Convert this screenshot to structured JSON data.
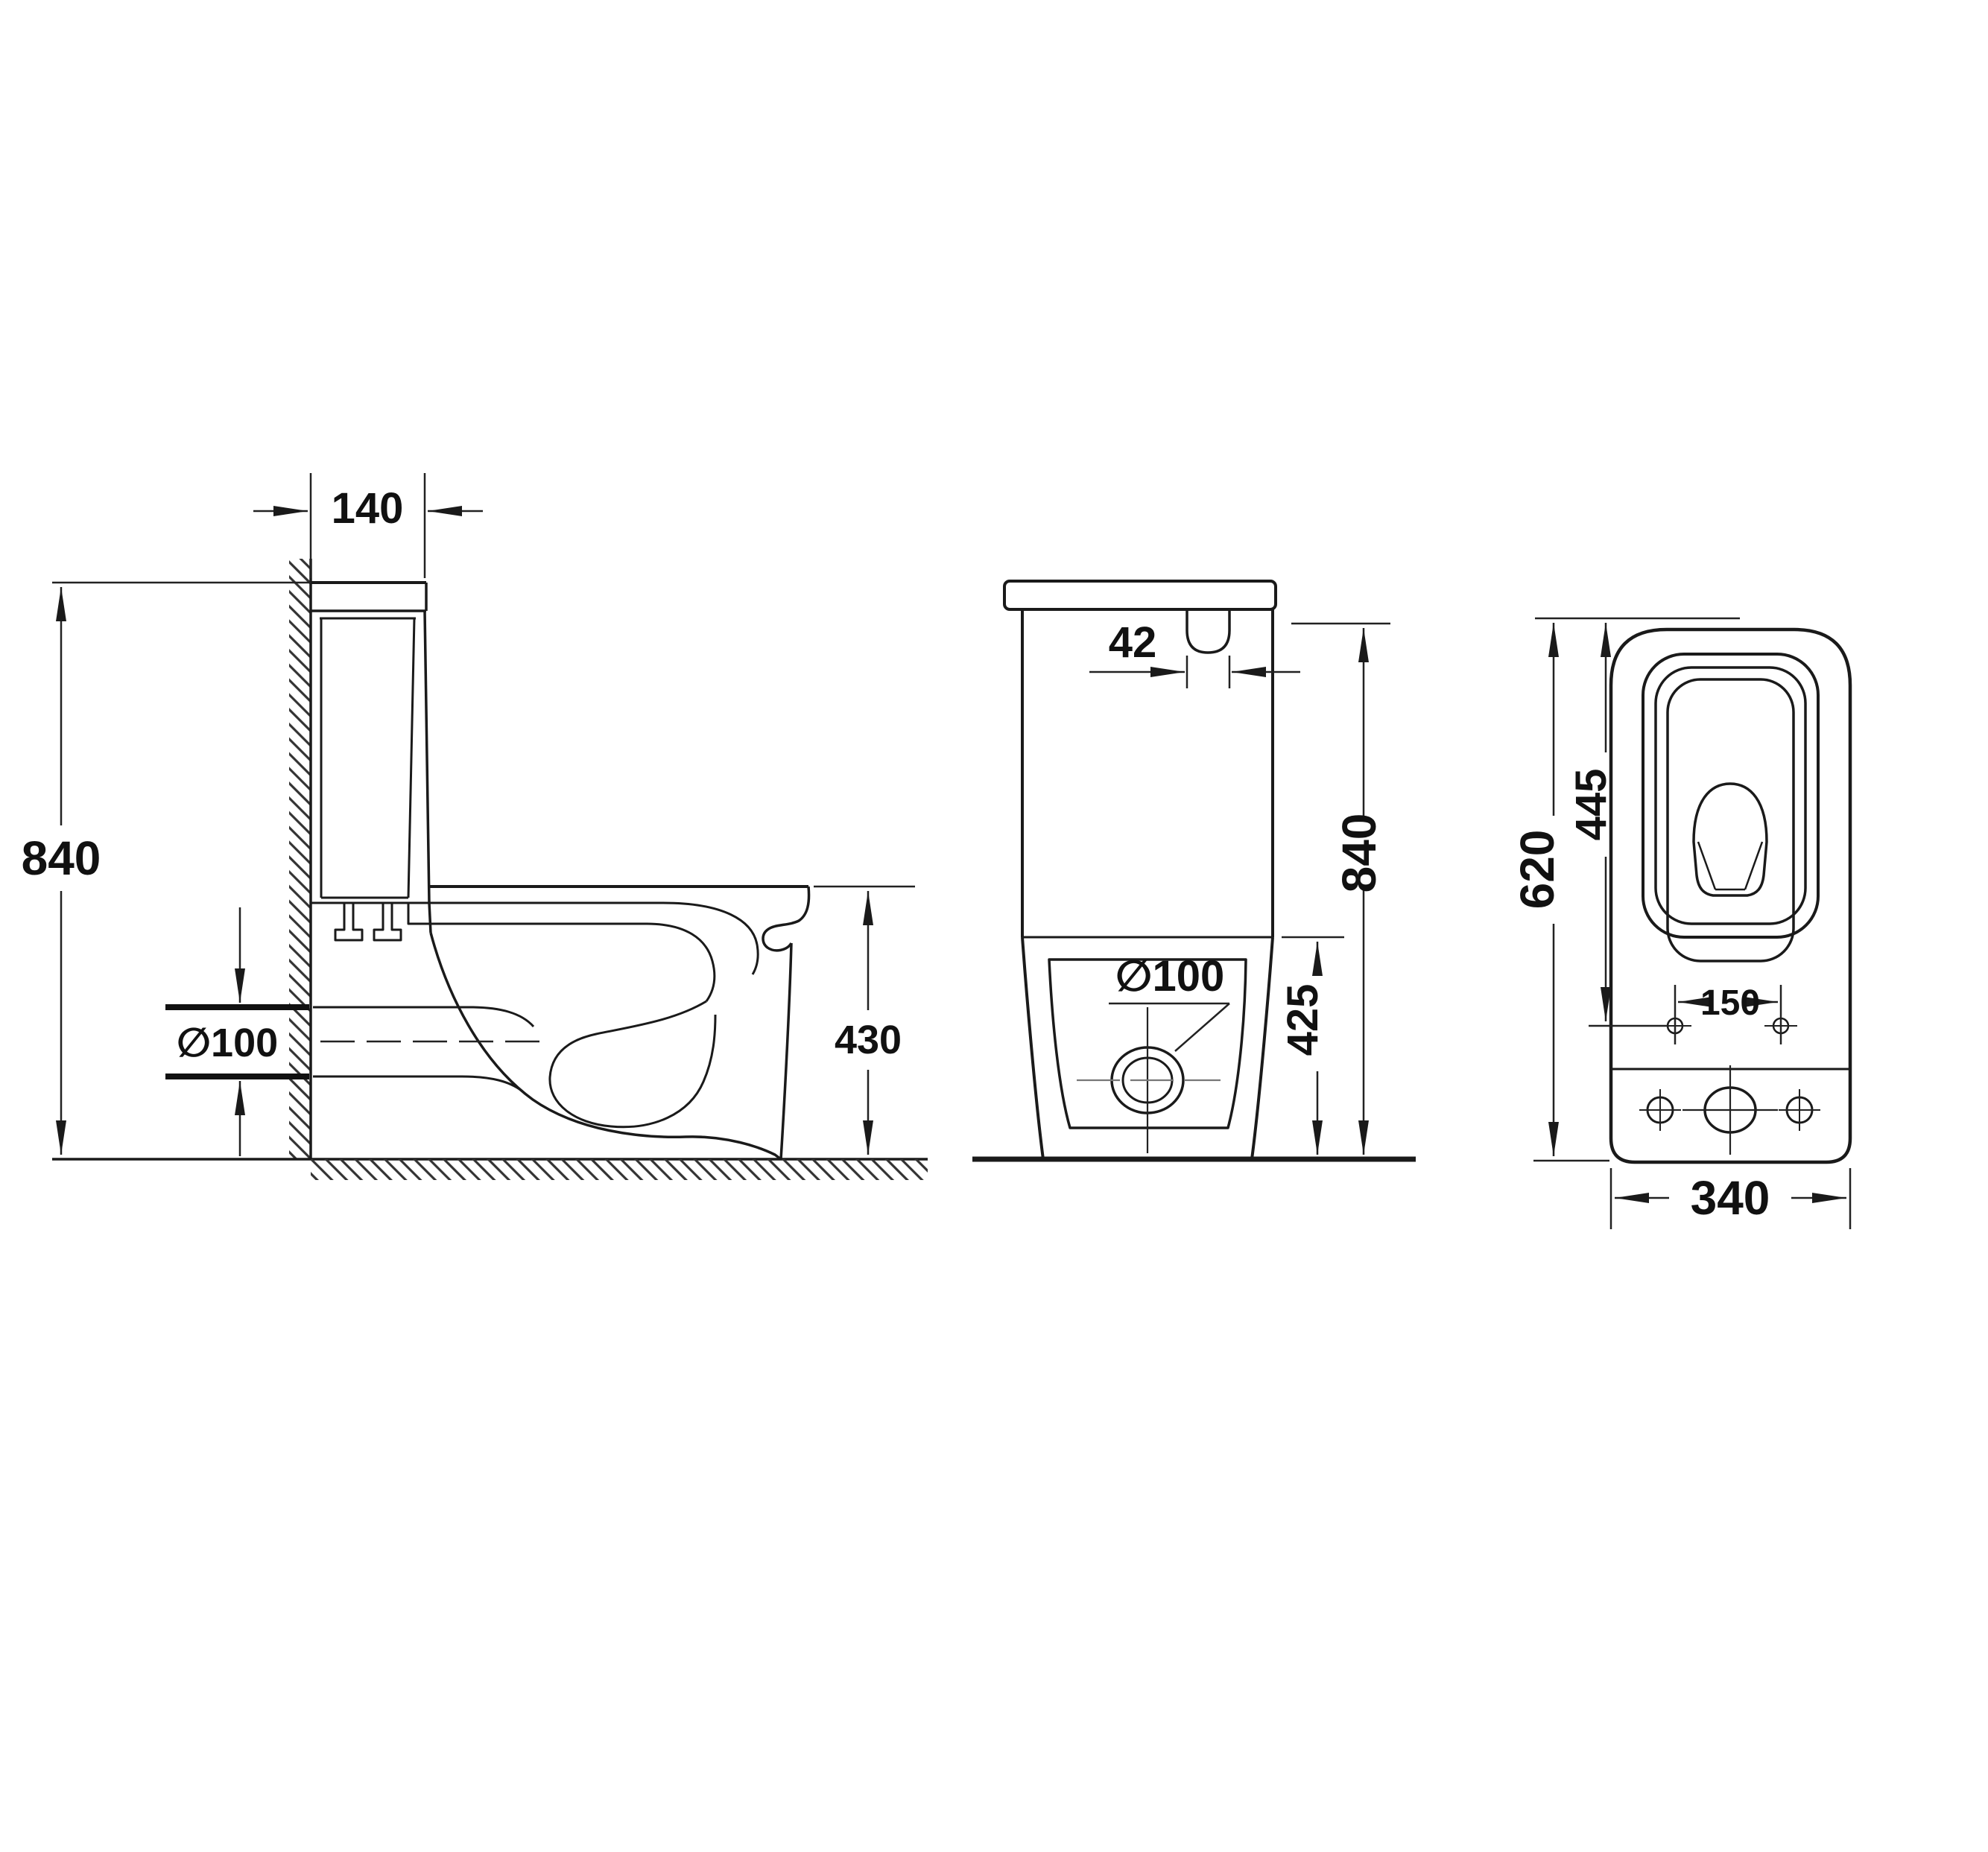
{
  "drawing": {
    "type": "technical-dimension-drawing",
    "subject": "close-coupled toilet, three orthographic views",
    "units": "mm",
    "colors": {
      "line": "#1a1a1a",
      "dimension_line": "#222222",
      "background": "#ffffff",
      "text": "#111111"
    },
    "views": {
      "side_section": {
        "name": "side cutaway view",
        "labels": {
          "cistern_depth": "140",
          "total_height": "840",
          "outlet_diameter": "∅100",
          "bowl_height": "430"
        }
      },
      "front": {
        "name": "front view",
        "labels": {
          "button_width": "42",
          "total_height": "840",
          "outlet_diameter": "∅100",
          "lower_height": "425"
        }
      },
      "top": {
        "name": "top (plan) view",
        "labels": {
          "total_depth": "620",
          "seat_depth": "445",
          "bolt_hole_spacing": "150",
          "body_width": "340"
        }
      }
    }
  }
}
